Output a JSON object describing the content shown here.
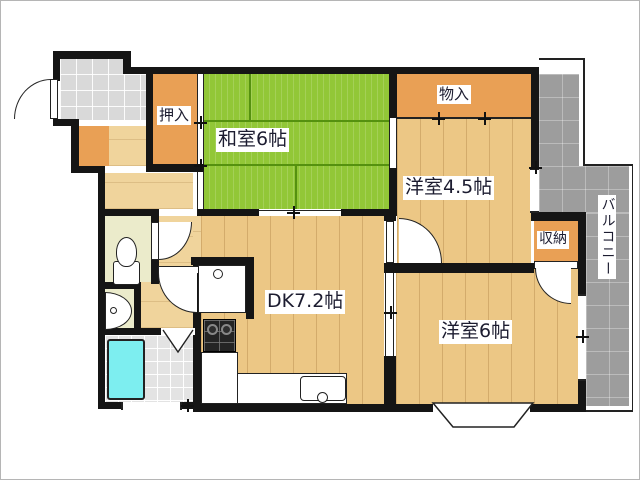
{
  "floorplan": {
    "type": "japanese-apartment-2dk",
    "rooms": {
      "washitsu": "和室6帖",
      "youshitsu45": "洋室4.5帖",
      "youshitsu6": "洋室6帖",
      "dk": "DK7.2帖",
      "oshiire": "押入",
      "monoire": "物入",
      "shuunou": "収納",
      "balcony": "バルコニー"
    },
    "colors": {
      "tatami_green": "#92c737",
      "wood_floor": "#ecc785",
      "closet_orange": "#e9a055",
      "balcony_gray": "#9d9d9d",
      "entry_tile_gray": "#d9d9d9",
      "bathtub_cyan": "#7deef0",
      "wall_black": "#151515",
      "label_text": "#1c1c30"
    }
  }
}
